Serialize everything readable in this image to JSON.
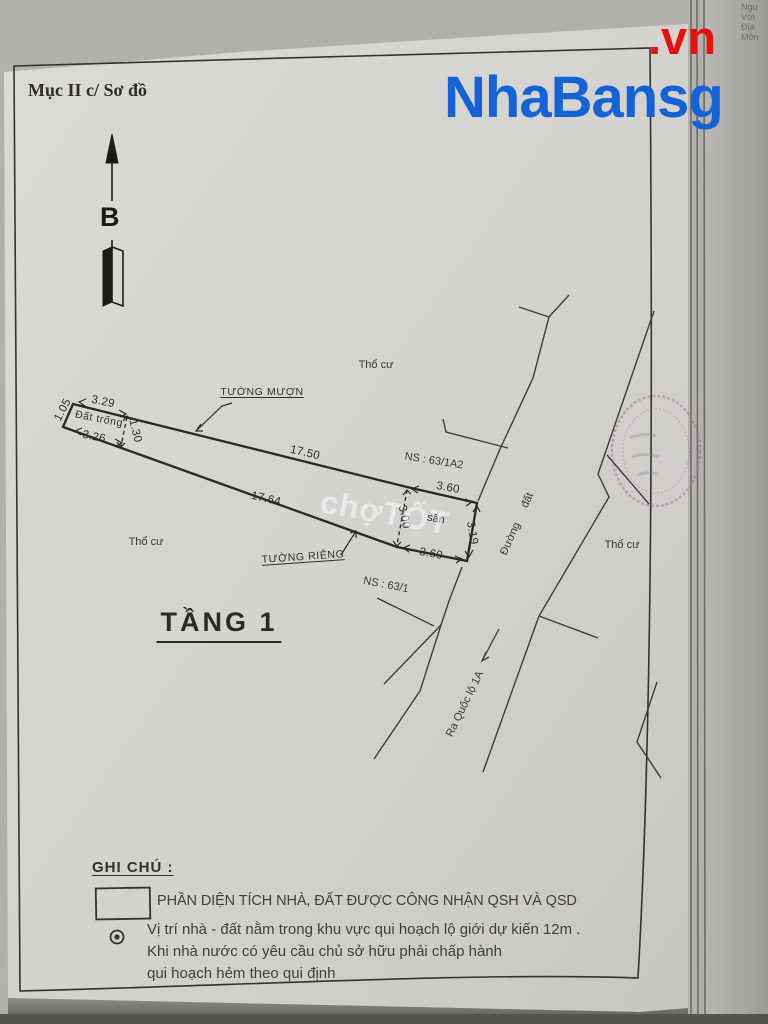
{
  "watermark": {
    "brand": "NhaBansg",
    "suffix": ".vn",
    "brand_color": "#1463d6",
    "suffix_color": "#e8100c",
    "chotot": "chợTỐT"
  },
  "corner_fragments": {
    "l1": "Ngư",
    "l2": "Với",
    "l3": "Địa",
    "l4": "Môn"
  },
  "page": {
    "section_title": "Mục II c/ Sơ đồ",
    "north_label": "B",
    "floor_title": "TẦNG 1"
  },
  "diagram": {
    "labels": {
      "tuong_muon": "TƯỜNG MƯỢN",
      "tuong_rieng": "TƯỜNG RIÊNG",
      "dat_trong": "Đất trống",
      "tho_cu_top": "Thổ cư",
      "tho_cu_left": "Thổ cư",
      "tho_cu_right": "Thổ cư",
      "san": "sân",
      "ns_63_1a2": "NS : 63/1A2",
      "ns_63_1": "NS : 63/1",
      "duong_dat": "Đường đất",
      "ra_quoc_lo": "Ra Quốc lộ 1A"
    },
    "dimensions": {
      "left_edge": "1.05",
      "top_left": "3.29",
      "bottom_left": "3.26",
      "width_left": "1.30",
      "top": "17.50",
      "bottom": "17.64",
      "san_top": "3.60",
      "san_bottom": "3.60",
      "san_left": "3.00",
      "san_right": "3.19"
    }
  },
  "legend": {
    "title": "GHI CHÚ :",
    "item1": "PHẦN DIỆN TÍCH NHÀ, ĐẤT ĐƯỢC CÔNG NHẬN QSH VÀ QSD",
    "item2_line1": "Vị trí nhà - đất nằm trong khu vực qui hoạch lộ giới dự kiến 12m .",
    "item2_line2": "Khi nhà nước có yêu cầu chủ sở hữu phải chấp hành",
    "item2_line3": "qui hoạch hẻm theo qui định"
  }
}
